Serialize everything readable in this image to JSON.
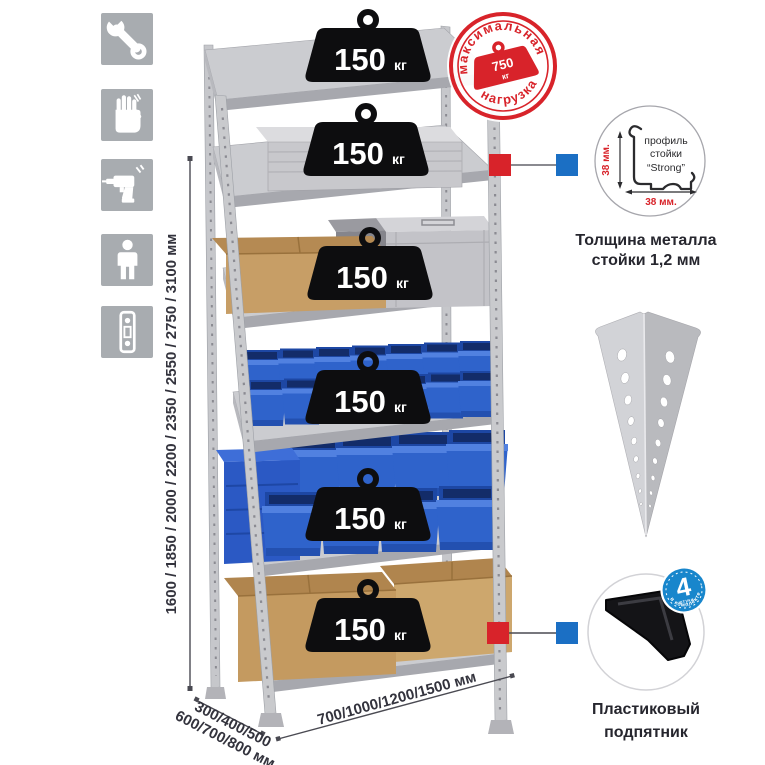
{
  "canvas": {
    "background": "#ffffff"
  },
  "colors": {
    "accent_red": "#d8232a",
    "accent_blue": "#1b6fc4",
    "badge_blue": "#1886cc",
    "metal_light": "#cbccd0",
    "metal_mid": "#a7a8ae",
    "bin_blue": "#2f63cb",
    "cardboard": "#c79e66",
    "weight_black": "#0d0d0f",
    "text_dark": "#33333d"
  },
  "tool_icons": [
    {
      "name": "wrench"
    },
    {
      "name": "gloves"
    },
    {
      "name": "drill"
    },
    {
      "name": "assembly-person"
    },
    {
      "name": "level"
    }
  ],
  "max_load_stamp": {
    "arc_top": "максимальная",
    "arc_bottom": "нагрузка",
    "value": "750",
    "unit": "кг"
  },
  "shelf_load": {
    "value": "150",
    "unit": "кг",
    "per_shelf_count": 6
  },
  "dimensions": {
    "height": "1600 / 1850 / 2000 / 2200 / 2350 / 2550 / 2750 / 3100 мм",
    "depth_line1": "300/400/500",
    "depth_line2": "600/700/800 мм",
    "width": "700/1000/1200/1500 мм"
  },
  "profile_detail": {
    "label_line1": "профиль",
    "label_line2": "стойки",
    "label_line3": "“Strong”",
    "dim_v": "38 мм.",
    "dim_h": "38 мм.",
    "caption_line1": "Толщина металла",
    "caption_line2": "стойки 1,2 мм"
  },
  "foot_detail": {
    "badge_value": "4",
    "badge_word": "штуки",
    "badge_arc": "в комплекте",
    "caption_line1": "Пластиковый",
    "caption_line2": "подпятник"
  }
}
